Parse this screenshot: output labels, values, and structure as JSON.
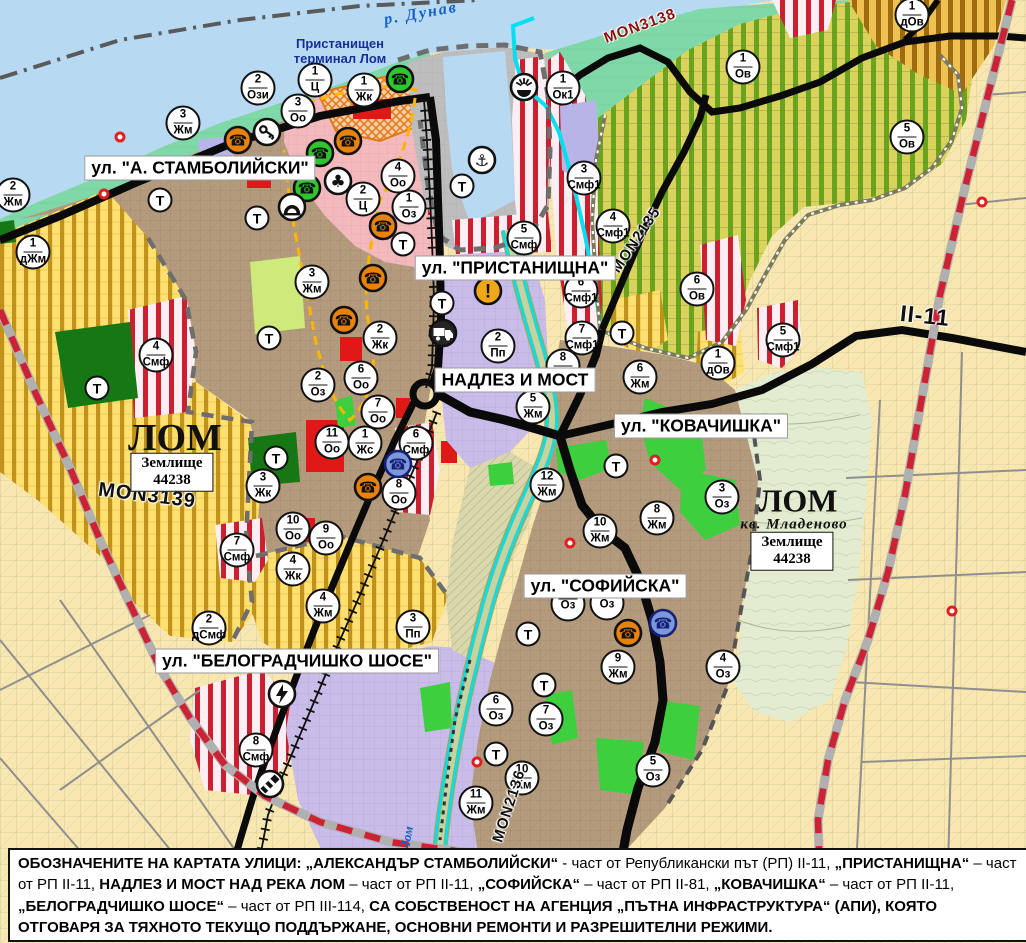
{
  "colors": {
    "water": "#b7d9f2",
    "mint": "#7fd8a8",
    "tan": "#b59b7d",
    "beige": "#f8e7b0",
    "lilac": "#c9bce8",
    "pink": "#f3b9bd",
    "grayPort": "#bdbdbd",
    "vineBg": "#d9d35e",
    "vineStripe": "#6aa41e",
    "yellowBg": "#ffe070",
    "yellowStripe": "#b8860b",
    "brownBg": "#edc252",
    "brownStripe": "#a06a10",
    "redStripeBg": "#fceef2",
    "redStripe": "#cc2030",
    "redZone": "#e01818",
    "greenBright": "#3ecf3e",
    "greenDark": "#157815",
    "greenLight": "#cdea7a",
    "paleGreen": "#e3ecd0",
    "khaki": "#d8d8ac",
    "cyan": "#00e0f0",
    "road": "#0a0a0a",
    "redDash": "#cc2233",
    "grayRoad": "#b0b0b0",
    "borderGray": "#666666",
    "lavender": "#b9b4e8"
  },
  "water_label": {
    "text": "р. Дунав",
    "x": 421,
    "y": 14
  },
  "port_terminal_label": {
    "text": "Пристанищен\nтерминал Лом",
    "x": 340,
    "y": 52
  },
  "river_label": {
    "text": "Лом",
    "x": 407,
    "y": 838
  },
  "city_labels": [
    {
      "text": "ЛОМ",
      "x": 175,
      "y": 438,
      "size": 38
    },
    {
      "text": "ЛОМ",
      "x": 798,
      "y": 501,
      "size": 32
    }
  ],
  "district_label": {
    "text": "кв. Младеново",
    "x": 794,
    "y": 525
  },
  "land_plates": [
    {
      "line1": "Землище",
      "line2": "44238",
      "x": 172,
      "y": 472
    },
    {
      "line1": "Землище",
      "line2": "44238",
      "x": 792,
      "y": 551
    }
  ],
  "road_labels": [
    {
      "text": "MON3139",
      "x": 147,
      "y": 496,
      "rot": 7,
      "size": 20,
      "color": "#111111"
    },
    {
      "text": "MON3138",
      "x": 640,
      "y": 26,
      "rot": -20,
      "size": 15,
      "color": "#8a1010"
    },
    {
      "text": "MON2135",
      "x": 636,
      "y": 240,
      "rot": -56,
      "size": 15,
      "color": "#111111"
    },
    {
      "text": "MON2136",
      "x": 509,
      "y": 806,
      "rot": -72,
      "size": 15,
      "color": "#111111"
    },
    {
      "text": "II-11",
      "x": 925,
      "y": 316,
      "rot": 6,
      "size": 23,
      "color": "#111111"
    }
  ],
  "street_labels": [
    {
      "text": "ул. \"А. СТАМБОЛИЙСКИ\"",
      "x": 200,
      "y": 168
    },
    {
      "text": "ул. \"ПРИСТАНИЩНА\"",
      "x": 515,
      "y": 268
    },
    {
      "text": "НАДЛЕЗ И МОСТ",
      "x": 515,
      "y": 380
    },
    {
      "text": "ул. \"КОВАЧИШКА\"",
      "x": 701,
      "y": 426
    },
    {
      "text": "ул. \"СОФИЙСКА\"",
      "x": 605,
      "y": 586
    },
    {
      "text": "ул. \"БЕЛОГРАДЧИШКО ШОСЕ\"",
      "x": 297,
      "y": 661
    }
  ],
  "t_label": "Т",
  "zone_circles": [
    {
      "n": "2",
      "code": "Ози",
      "x": 258,
      "y": 88
    },
    {
      "n": "1",
      "code": "Ц",
      "x": 315,
      "y": 80
    },
    {
      "n": "1",
      "code": "Жк",
      "x": 364,
      "y": 90
    },
    {
      "n": "3",
      "code": "Жм",
      "x": 183,
      "y": 123
    },
    {
      "n": "3",
      "code": "Оо",
      "x": 298,
      "y": 111
    },
    {
      "n": "2",
      "code": "Жм",
      "x": 13,
      "y": 195
    },
    {
      "n": "4",
      "code": "Оо",
      "x": 398,
      "y": 176
    },
    {
      "n": "2",
      "code": "Ц",
      "x": 363,
      "y": 199
    },
    {
      "n": "1",
      "code": "Оз",
      "x": 409,
      "y": 207
    },
    {
      "n": "1",
      "code": "дЖм",
      "x": 33,
      "y": 252
    },
    {
      "n": "1",
      "code": "Ок1",
      "x": 563,
      "y": 88
    },
    {
      "n": "3",
      "code": "Смф1",
      "x": 584,
      "y": 178
    },
    {
      "n": "4",
      "code": "Смф1",
      "x": 613,
      "y": 226
    },
    {
      "n": "5",
      "code": "Смф",
      "x": 524,
      "y": 238
    },
    {
      "n": "1",
      "code": "Ов",
      "x": 743,
      "y": 67
    },
    {
      "n": "5",
      "code": "Ов",
      "x": 907,
      "y": 137
    },
    {
      "n": "1",
      "code": "дОв",
      "x": 912,
      "y": 15
    },
    {
      "n": "6",
      "code": "Ов",
      "x": 697,
      "y": 289
    },
    {
      "n": "1",
      "code": "дОв",
      "x": 718,
      "y": 363
    },
    {
      "n": "5",
      "code": "Смф1",
      "x": 783,
      "y": 340
    },
    {
      "n": "6",
      "code": "Смф1",
      "x": 581,
      "y": 291
    },
    {
      "n": "7",
      "code": "Смф1",
      "x": 582,
      "y": 338
    },
    {
      "n": "3",
      "code": "Жм",
      "x": 312,
      "y": 282
    },
    {
      "n": "2",
      "code": "Жк",
      "x": 380,
      "y": 338
    },
    {
      "n": "6",
      "code": "Оо",
      "x": 361,
      "y": 378
    },
    {
      "n": "2",
      "code": "Оз",
      "x": 318,
      "y": 385
    },
    {
      "n": "7",
      "code": "Оо",
      "x": 378,
      "y": 412
    },
    {
      "n": "11",
      "code": "Оо",
      "x": 332,
      "y": 442
    },
    {
      "n": "1",
      "code": "Жс",
      "x": 365,
      "y": 443
    },
    {
      "n": "6",
      "code": "Смф",
      "x": 416,
      "y": 443
    },
    {
      "n": "8",
      "code": "Оо",
      "x": 399,
      "y": 493
    },
    {
      "n": "3",
      "code": "Жк",
      "x": 263,
      "y": 486
    },
    {
      "n": "4",
      "code": "Смф",
      "x": 156,
      "y": 355
    },
    {
      "n": "10",
      "code": "Оо",
      "x": 293,
      "y": 529
    },
    {
      "n": "9",
      "code": "Оо",
      "x": 326,
      "y": 538
    },
    {
      "n": "4",
      "code": "Жк",
      "x": 293,
      "y": 569
    },
    {
      "n": "4",
      "code": "Жм",
      "x": 323,
      "y": 606
    },
    {
      "n": "7",
      "code": "Смф",
      "x": 237,
      "y": 550
    },
    {
      "n": "2",
      "code": "Пп",
      "x": 498,
      "y": 346
    },
    {
      "n": "8",
      "code": "Жм",
      "x": 563,
      "y": 366
    },
    {
      "n": "5",
      "code": "Жм",
      "x": 533,
      "y": 407
    },
    {
      "n": "6",
      "code": "Жм",
      "x": 640,
      "y": 377
    },
    {
      "n": "12",
      "code": "Жм",
      "x": 547,
      "y": 485
    },
    {
      "n": "10",
      "code": "Жм",
      "x": 600,
      "y": 531
    },
    {
      "n": "8",
      "code": "Жм",
      "x": 657,
      "y": 518
    },
    {
      "n": "3",
      "code": "Оз",
      "x": 722,
      "y": 497
    },
    {
      "n": "9",
      "code": "Жм",
      "x": 618,
      "y": 667
    },
    {
      "n": "4",
      "code": "Оз",
      "x": 723,
      "y": 667
    },
    {
      "n": "6",
      "code": "Оз",
      "x": 496,
      "y": 709
    },
    {
      "n": "7",
      "code": "Оз",
      "x": 546,
      "y": 719
    },
    {
      "n": "5",
      "code": "Оз",
      "x": 653,
      "y": 770
    },
    {
      "n": "10",
      "code": "Жм",
      "x": 522,
      "y": 778
    },
    {
      "n": "11",
      "code": "Жм",
      "x": 476,
      "y": 803
    },
    {
      "n": "2",
      "code": "дСмф",
      "x": 209,
      "y": 628
    },
    {
      "n": "3",
      "code": "Пп",
      "x": 413,
      "y": 627
    },
    {
      "n": "8",
      "code": "Смф",
      "x": 256,
      "y": 750
    },
    {
      "n": "",
      "code": "Оз",
      "x": 568,
      "y": 604
    },
    {
      "n": "",
      "code": "Оз",
      "x": 607,
      "y": 603
    }
  ],
  "t_circles": [
    {
      "x": 160,
      "y": 200
    },
    {
      "x": 257,
      "y": 218
    },
    {
      "x": 462,
      "y": 186
    },
    {
      "x": 403,
      "y": 244
    },
    {
      "x": 269,
      "y": 338
    },
    {
      "x": 97,
      "y": 388
    },
    {
      "x": 276,
      "y": 458
    },
    {
      "x": 442,
      "y": 303
    },
    {
      "x": 622,
      "y": 333
    },
    {
      "x": 616,
      "y": 466
    },
    {
      "x": 528,
      "y": 634
    },
    {
      "x": 544,
      "y": 685
    },
    {
      "x": 496,
      "y": 754
    }
  ],
  "icons": [
    {
      "type": "phone-orange",
      "x": 238,
      "y": 140
    },
    {
      "type": "phone-orange",
      "x": 348,
      "y": 141
    },
    {
      "type": "phone-orange",
      "x": 383,
      "y": 226
    },
    {
      "type": "phone-orange",
      "x": 373,
      "y": 278
    },
    {
      "type": "phone-orange",
      "x": 344,
      "y": 320
    },
    {
      "type": "phone-orange",
      "x": 368,
      "y": 487
    },
    {
      "type": "phone-orange",
      "x": 628,
      "y": 633
    },
    {
      "type": "phone-green",
      "x": 400,
      "y": 79
    },
    {
      "type": "phone-green",
      "x": 320,
      "y": 153
    },
    {
      "type": "phone-green",
      "x": 307,
      "y": 188
    },
    {
      "type": "phone-blue",
      "x": 398,
      "y": 464
    },
    {
      "type": "phone-blue",
      "x": 663,
      "y": 623
    },
    {
      "type": "key",
      "x": 267,
      "y": 132
    },
    {
      "type": "trefoil",
      "x": 338,
      "y": 181
    },
    {
      "type": "arch",
      "x": 292,
      "y": 207
    },
    {
      "type": "anchor",
      "x": 482,
      "y": 160
    },
    {
      "type": "sun",
      "x": 524,
      "y": 87
    },
    {
      "type": "warning",
      "x": 488,
      "y": 291
    },
    {
      "type": "truck",
      "x": 443,
      "y": 333
    },
    {
      "type": "lightning",
      "x": 282,
      "y": 694
    },
    {
      "type": "barrier",
      "x": 270,
      "y": 784
    }
  ],
  "red_dots": [
    {
      "x": 120,
      "y": 137
    },
    {
      "x": 104,
      "y": 194
    },
    {
      "x": 655,
      "y": 460
    },
    {
      "x": 570,
      "y": 543
    },
    {
      "x": 477,
      "y": 762
    },
    {
      "x": 952,
      "y": 611
    },
    {
      "x": 982,
      "y": 202
    }
  ],
  "footnote": {
    "segments": [
      {
        "t": "ОБОЗНАЧЕНИТЕ НА КАРТАТА УЛИЦИ: „АЛЕКСАНДЪР СТАМБОЛИЙСКИ“",
        "b": true
      },
      {
        "t": " - част от Републикански път (РП) II-11, ",
        "b": false
      },
      {
        "t": "„ПРИСТАНИЩНА“",
        "b": true
      },
      {
        "t": " – част от РП II-11, ",
        "b": false
      },
      {
        "t": "НАДЛЕЗ И МОСТ НАД РЕКА ЛОМ",
        "b": true
      },
      {
        "t": " – част от РП II-11, ",
        "b": false
      },
      {
        "t": "„СОФИЙСКА“",
        "b": true
      },
      {
        "t": " – част от РП II-81, ",
        "b": false
      },
      {
        "t": "„КОВАЧИШКА“",
        "b": true
      },
      {
        "t": " – част от РП II-11, ",
        "b": false
      },
      {
        "t": "„БЕЛОГРАДЧИШКО ШОСЕ“",
        "b": true
      },
      {
        "t": " – част от РП III-114, ",
        "b": false
      },
      {
        "t": "СА СОБСТВЕНОСТ НА АГЕНЦИЯ „ПЪТНА ИНФРАСТРУКТУРА“ (АПИ), КОЯТО ОТГОВАРЯ ЗА ТЯХНОТО ТЕКУЩО ПОДДЪРЖАНЕ, ОСНОВНИ РЕМОНТИ И РАЗРЕШИТЕЛНИ РЕЖИМИ.",
        "b": true
      }
    ]
  }
}
